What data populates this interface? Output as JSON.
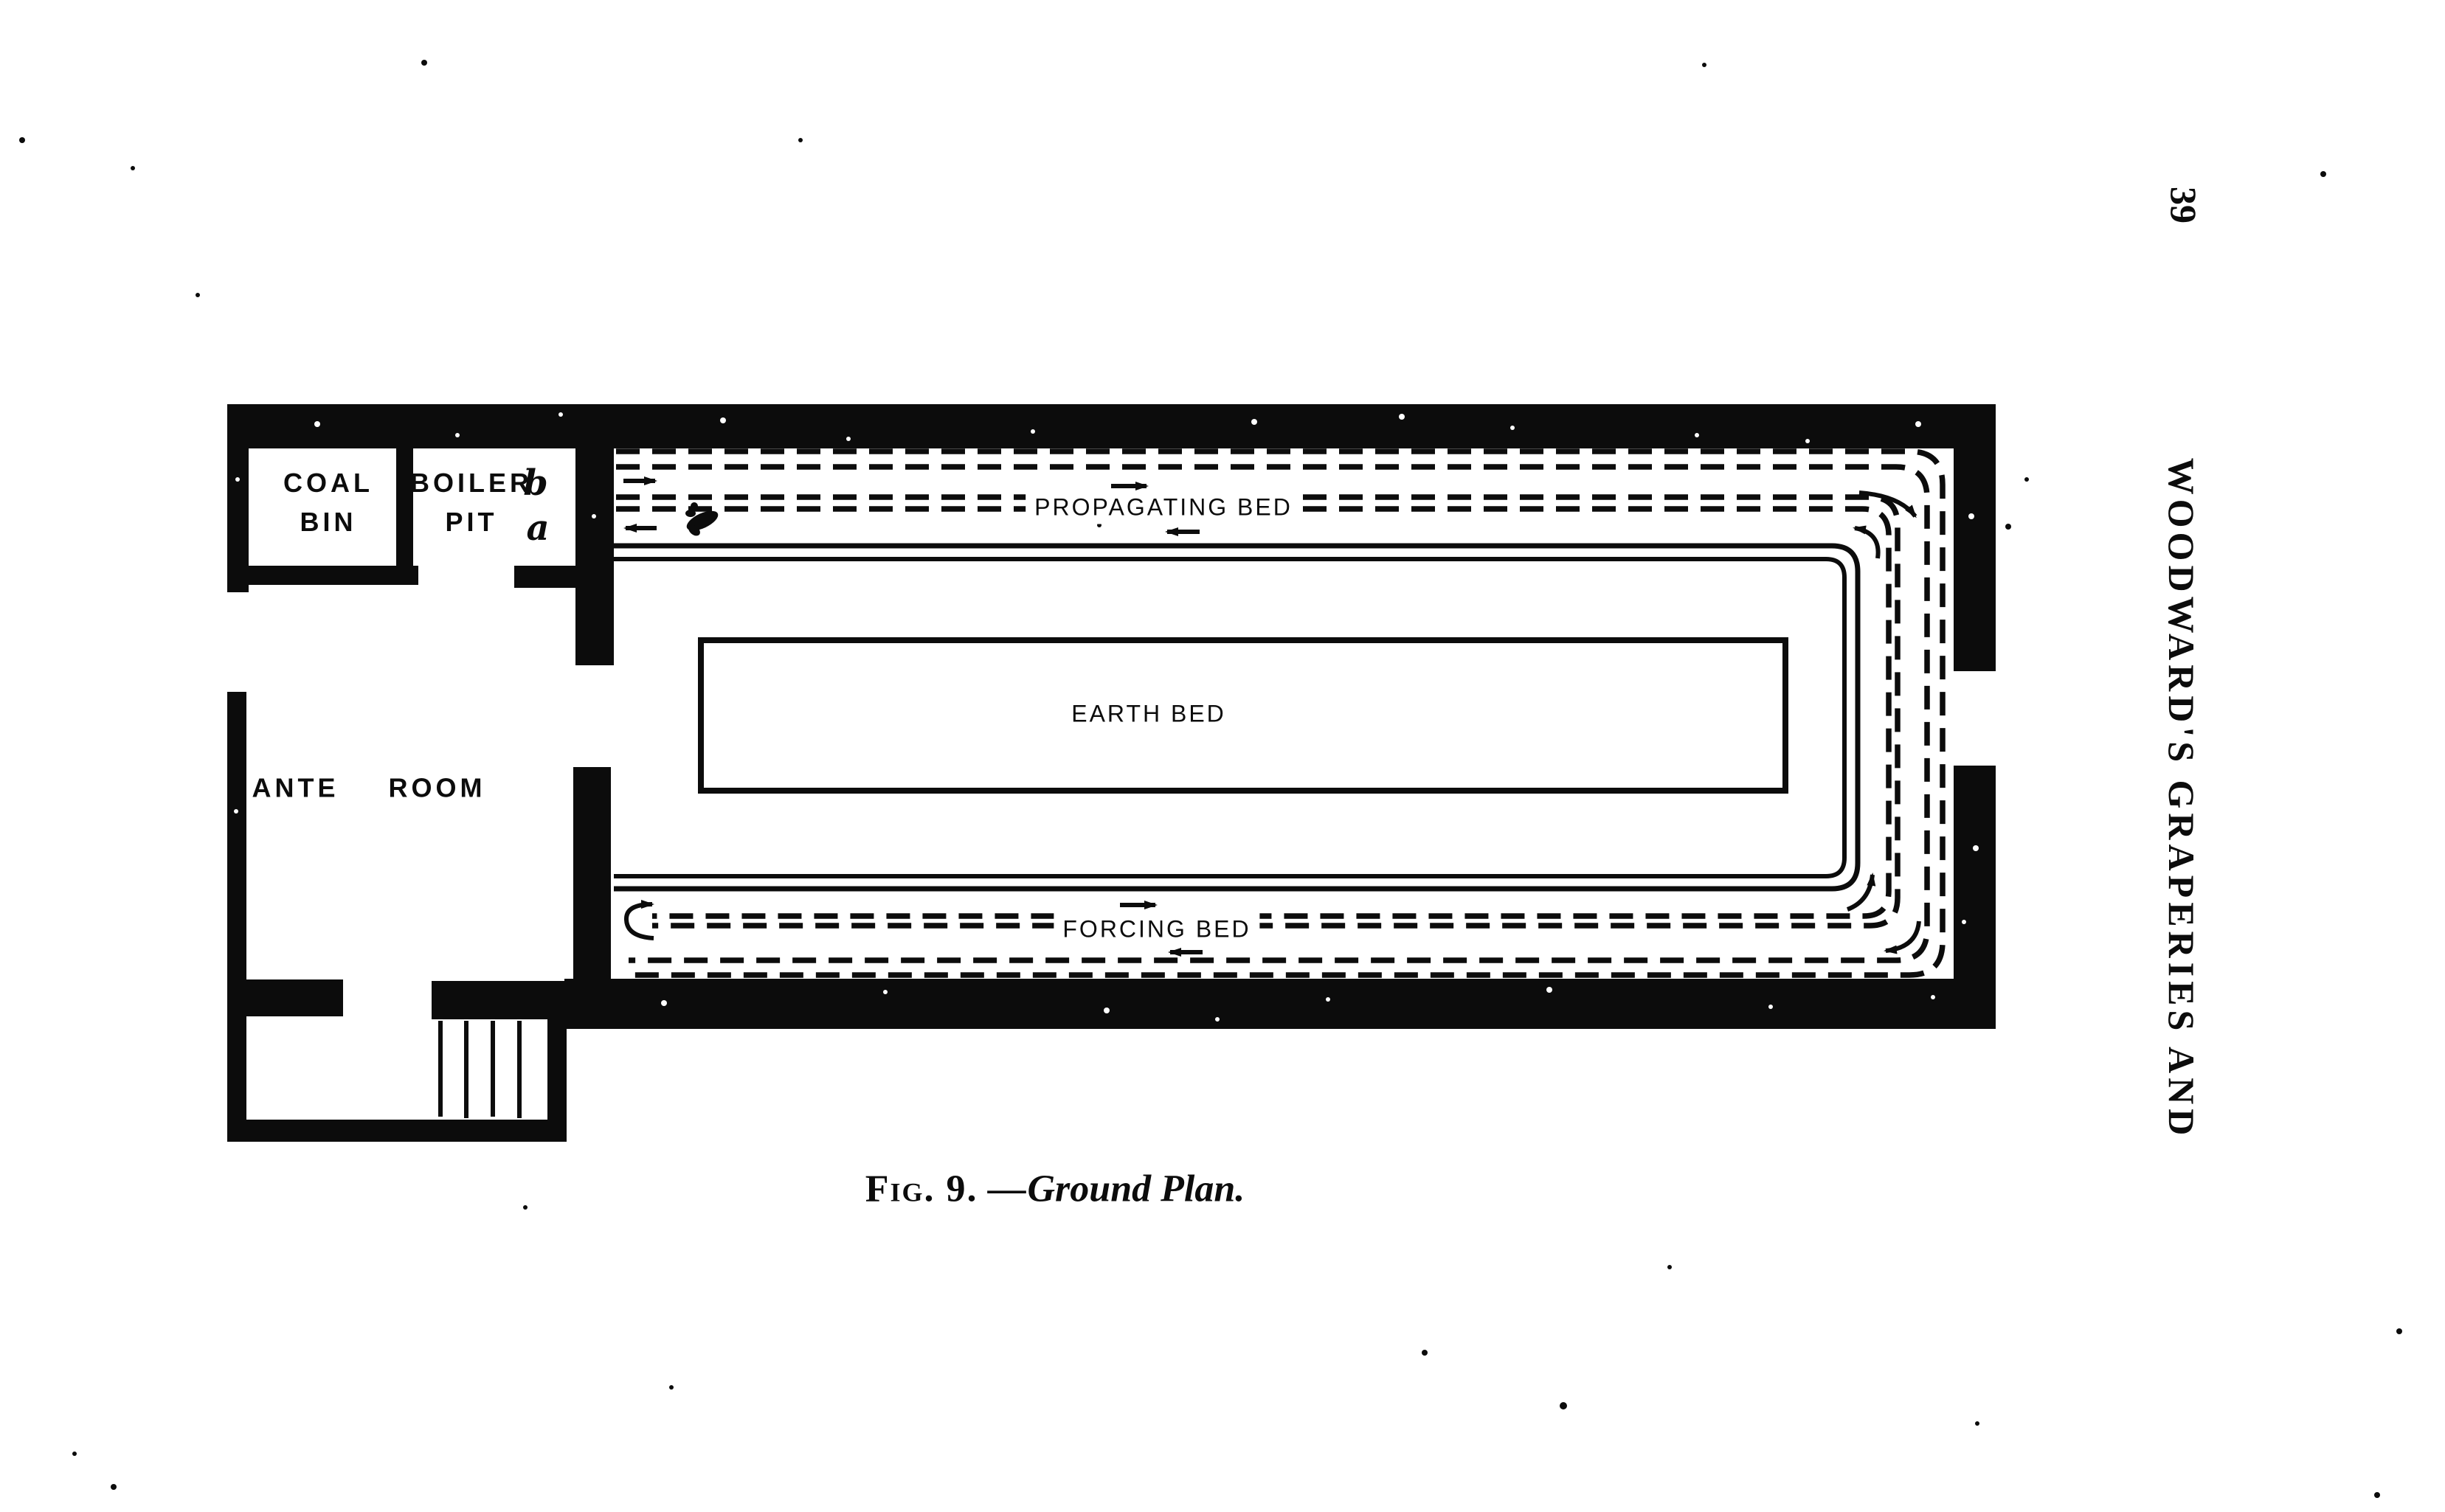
{
  "page": {
    "page_number": "39",
    "running_header": "WOODWARD'S GRAPERIES AND",
    "caption_fig": "Fig. 9.",
    "caption_sep": "—",
    "caption_title": "Ground Plan."
  },
  "plan": {
    "coal_bin_line1": "COAL",
    "coal_bin_line2": "BIN",
    "boiler_pit_line1": "BOILER",
    "boiler_pit_line2": "PIT",
    "boiler_marker_b": "b",
    "boiler_marker_a": "a",
    "ante_room": "ANTE ROOM",
    "propagating_bed": "PROPAGATING BED",
    "earth_bed": "EARTH BED",
    "forcing_bed": "FORCING BED"
  },
  "colors": {
    "ink": "#0c0c0c",
    "paper": "#ffffff"
  }
}
